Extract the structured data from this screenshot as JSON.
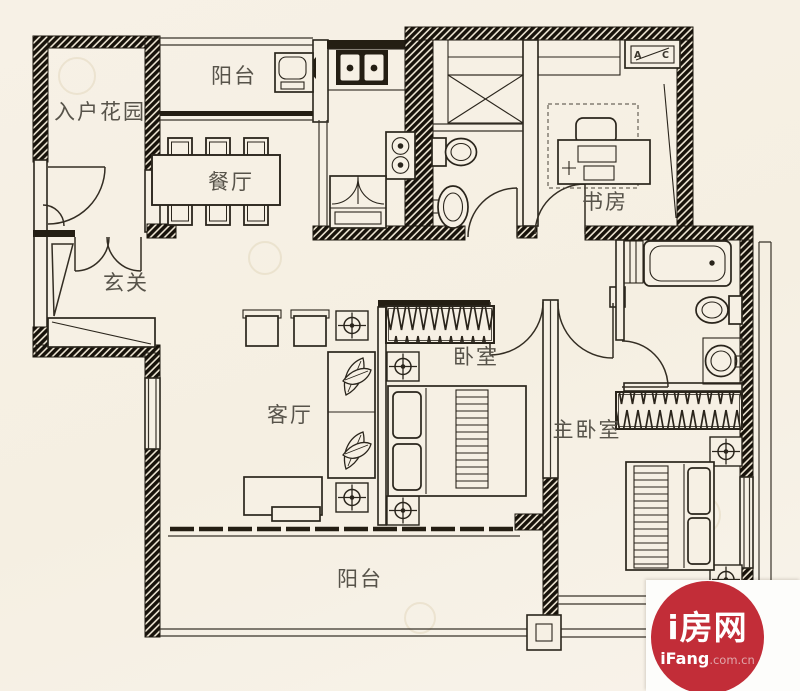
{
  "page": {
    "background": "#f5efe3",
    "type": "apartment-floor-plan"
  },
  "rooms": [
    {
      "name": "entry-garden",
      "label": "入户花园"
    },
    {
      "name": "balcony-top",
      "label": "阳台"
    },
    {
      "name": "dining-room",
      "label": "餐厅"
    },
    {
      "name": "foyer",
      "label": "玄关"
    },
    {
      "name": "study",
      "label": "书房"
    },
    {
      "name": "living-room",
      "label": "客厅"
    },
    {
      "name": "bedroom",
      "label": "卧室"
    },
    {
      "name": "master-bedroom",
      "label": "主卧室"
    },
    {
      "name": "balcony-bottom",
      "label": "阳台"
    }
  ],
  "ac_unit": {
    "label_a": "A",
    "label_c": "C"
  },
  "logo": {
    "brand": "i房网",
    "site_name": "iFang",
    "site_tld": ".com.cn"
  },
  "colors": {
    "wall_ink": "#1b160d",
    "label_gray": "#57534a",
    "logo_red": "#c22d38",
    "paper": "#f5efe3"
  }
}
